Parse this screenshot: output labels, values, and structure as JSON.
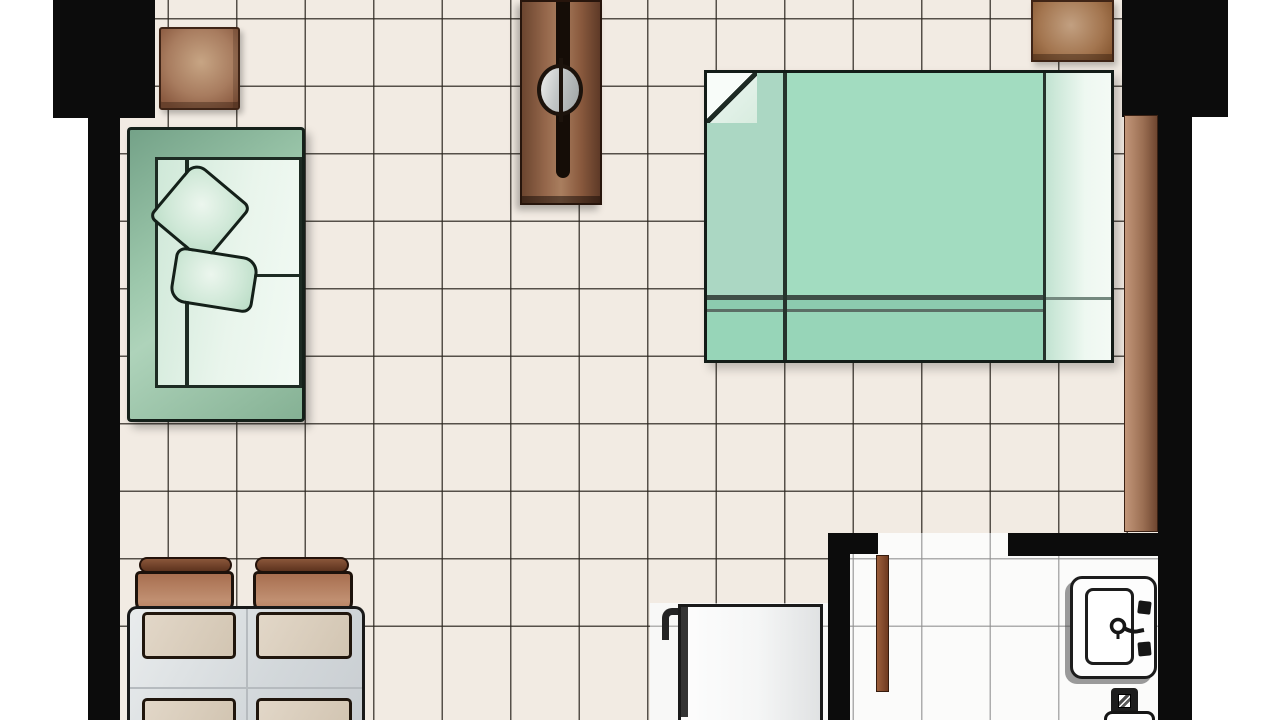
{
  "meta": {
    "type": "floor-plan",
    "description": "Top-down floor plan of a studio apartment with tiled floor"
  },
  "palette": {
    "wall_black": "#0c0c0c",
    "main_tile": "#f2ebe3",
    "tile_line": "#2a241e",
    "white_tile": "#fbfbfa",
    "wood_brown": "#9c7054",
    "sofa_green": "#9cc7ab",
    "bed_mint": "#a2dcc0",
    "table_gray": "#d7dadd",
    "chair_brown": "#b07a5a",
    "exterior_white": "#ffffff"
  },
  "rooms": {
    "main": {
      "label": "main room with cream tile floor"
    },
    "kitchen": {
      "label": "kitchen corner with white tile floor"
    },
    "bath": {
      "label": "bathroom with white tile floor"
    }
  },
  "furniture": {
    "side_table": {
      "label": "wooden side table"
    },
    "sofa": {
      "label": "green sofa seen from above"
    },
    "pillow_top": {
      "label": "sofa pillow"
    },
    "pillow_bottom": {
      "label": "sofa pillow"
    },
    "console": {
      "label": "wooden console with round knob"
    },
    "bed": {
      "label": "double bed with mint bedding"
    },
    "bed_fold": {
      "label": "folded sheet corner"
    },
    "nightstand_right": {
      "label": "wooden nightstand"
    },
    "entry_door": {
      "label": "wooden door leaf along right wall"
    },
    "chair_left": {
      "label": "dining chair"
    },
    "chair_right": {
      "label": "dining chair"
    },
    "dining_table": {
      "label": "dining table with place seats"
    },
    "seat_mats": {
      "label": "seat cushions on table"
    },
    "fridge": {
      "label": "refrigerator with door handle"
    },
    "bath_door": {
      "label": "open bathroom door leaf"
    },
    "sink": {
      "label": "bathroom washbasin with faucet"
    },
    "floor_drain": {
      "label": "floor drain square"
    },
    "toilet": {
      "label": "toilet, partially visible at edge"
    }
  },
  "walls": {
    "label": "black structural wall segments"
  }
}
